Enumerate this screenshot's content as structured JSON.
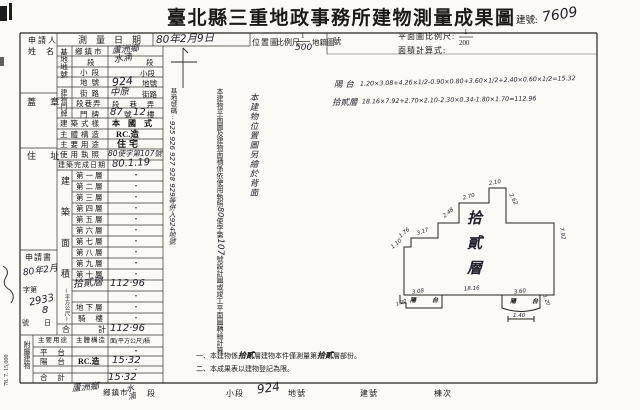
{
  "header": {
    "title": "臺北縣三重地政事務所建物測量成果圖",
    "building_no_label": "建號:",
    "building_no": "7609"
  },
  "scales": {
    "location_map": "位置圖",
    "scale_label": "比例尺:",
    "loc_num": "1",
    "loc_den": "500",
    "cadastral": "地籍圖",
    "sheet_no": "號",
    "plan_scale_label": "平面圖比例尺:",
    "plan_num": "1",
    "plan_den": "200",
    "area_formula_label": "面積計算式:"
  },
  "formulas": {
    "balcony_label": "陽 台",
    "balcony": "1.20×3.08+4.26×1/2-0.90×0.80+3.60×1/2+2.40×0.60×1/2=15.32",
    "floor12_label": "拾貳層",
    "floor12": "18.16×7.92+2.70×2.10-2.30×0.34-1.80×1.70=112.96"
  },
  "applicant": {
    "name1": "申請人",
    "name2": "姓 名",
    "seal": "蓋 章",
    "address": "住 址"
  },
  "application": {
    "label": "申請書",
    "date1": "80年2月",
    "date2": "8",
    "no_label": "字第",
    "no": "2933",
    "no_suffix": "號",
    "day_suffix": "日"
  },
  "survey": {
    "label": "測量日期",
    "value": "80年2月9日"
  },
  "site": {
    "group": "基地地號",
    "r1l": "鄉鎮市",
    "r1v": "蘆洲鄉",
    "r2l": "段",
    "r2v": "水湳",
    "r2s": "段",
    "r3l": "小段",
    "r3s": "小段",
    "r4l": "地號",
    "r4v": "924",
    "r4s": "地號"
  },
  "door": {
    "group": "建物門牌",
    "r1l": "街路",
    "r1v": "中原",
    "r1s": "街路",
    "r2l": "段巷弄",
    "r2s": "段 巷 弄",
    "r3l": "門牌",
    "no": "87",
    "no_label": "號",
    "fl": "12",
    "fl_label": "樓"
  },
  "info": {
    "style_label": "建築式樣",
    "style": "本 國 式",
    "struct_label": "主體構造",
    "struct": "RC.造",
    "use_label": "主要用途",
    "use": "住宅",
    "license_label": "使用執照",
    "license": "80使字第107號",
    "done_label": "建築完成日期",
    "done": "80.1.19"
  },
  "floor_area": {
    "group": "建築面積",
    "unit": "(平方公尺)",
    "rows": [
      {
        "label": "第一層",
        "value": "·"
      },
      {
        "label": "第二層",
        "value": "·"
      },
      {
        "label": "第三層",
        "value": "·"
      },
      {
        "label": "第四層",
        "value": "·"
      },
      {
        "label": "第五層",
        "value": "·"
      },
      {
        "label": "第六層",
        "value": "·"
      },
      {
        "label": "第七層",
        "value": "·"
      },
      {
        "label": "第八層",
        "value": "·"
      },
      {
        "label": "第九層",
        "value": "·"
      },
      {
        "label": "第十層",
        "value": "·"
      },
      {
        "label": "拾貳層",
        "value": "112·96"
      },
      {
        "label": "",
        "value": "·"
      },
      {
        "label": "地下層",
        "value": "·"
      },
      {
        "label": "騎 樓",
        "value": "·"
      },
      {
        "label": "合　計",
        "value": "112·96"
      }
    ]
  },
  "annex": {
    "group": "附屬建物",
    "h1": "主要用途",
    "h2": "主體構造",
    "h3": "面(平方公尺)積",
    "rows": [
      {
        "use": "平 台",
        "structure": "",
        "area": "·"
      },
      {
        "use": "陽 台",
        "structure": "RC.造",
        "area": "15·32"
      },
      {
        "use": "",
        "structure": "",
        "area": "·"
      },
      {
        "use": "合 計",
        "structure": "",
        "area": "15·32"
      }
    ]
  },
  "strips": {
    "site_no_label": "基地號碼:",
    "site_no": "925 926 927 928 929等併入924地號",
    "plan1": "本建物平面圖及建物面積係依使用執照",
    "plan2": "80",
    "plan3": "使字第",
    "plan4": "107",
    "plan5": "號設計圖或竣工平面圖轉繪計算",
    "location_note": "本建物位置圖另繪於背面"
  },
  "remarks": {
    "r1a": "一、本建物係",
    "r1b": "拾貳",
    "r1c": "層建物本件僅測量第",
    "r1d": "拾貳",
    "r1e": "層部份。",
    "r2": "二、本成果表以建物登記為限。"
  },
  "diagram": {
    "floor": "拾貳層",
    "bal_left": "陽 台",
    "bal_right": "陽 台",
    "d_110": "1.10",
    "d_176": "1.76",
    "d_317": "3.17",
    "d_248": "2.48",
    "d_270": "2.70",
    "d_210": "2.10",
    "d_262": "2.62",
    "d_792": "7.92",
    "d_1816": "18.16",
    "d_308": "3.08",
    "d_120l": "1.20",
    "d_360": "3.60",
    "d_120r": "1.20",
    "d_140": "1.40"
  },
  "footer": {
    "township_v": "蘆洲鄉",
    "township": "鄉鎮市",
    "section_v": "水湳",
    "section": "段",
    "subsection": "小段",
    "lot_v": "924",
    "lot": "地號",
    "bno": "建號",
    "unit": "棟次"
  },
  "print_code": "78. 7. 15,000"
}
